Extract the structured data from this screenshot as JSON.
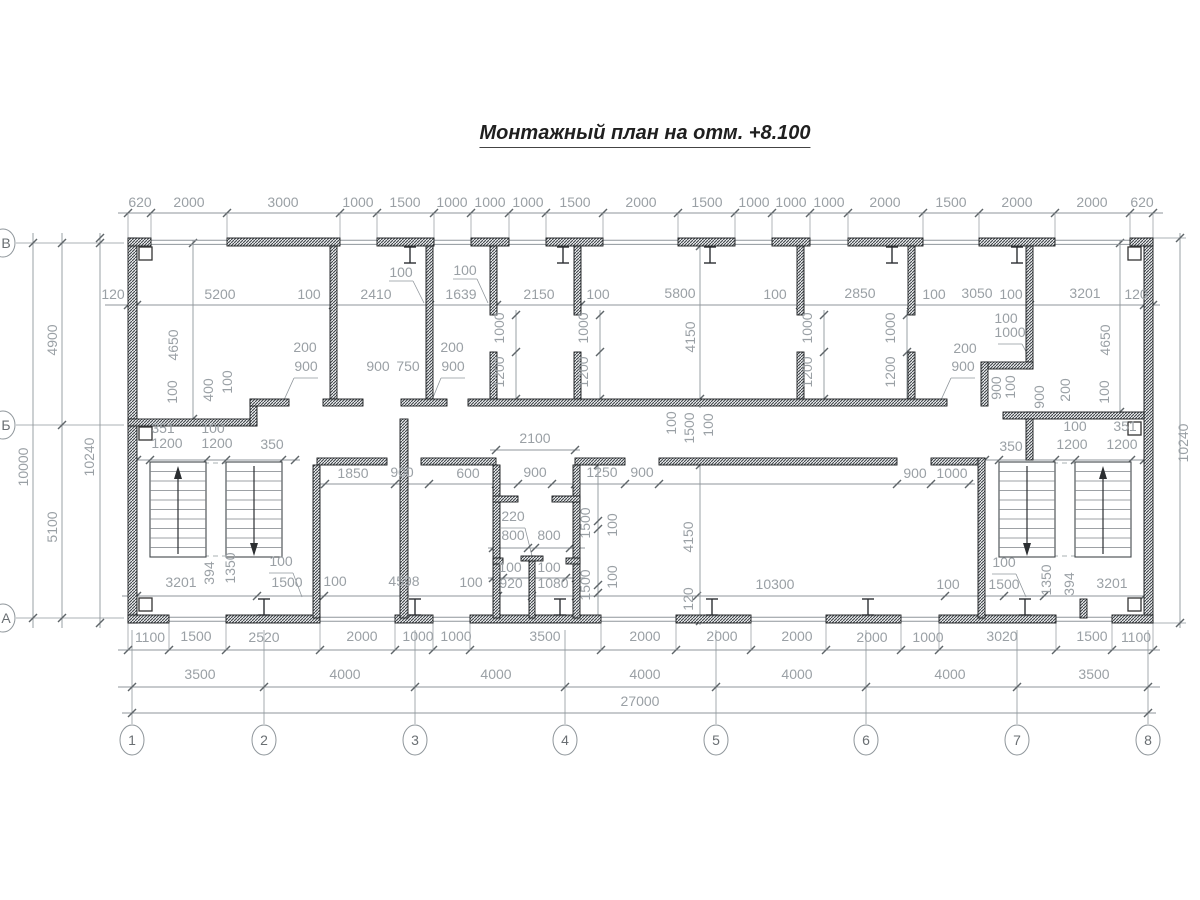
{
  "title": "Монтажный план на отм. +8.100",
  "colors": {
    "dim_text": "#9aa0a5",
    "dim_line": "#8f969b",
    "tick": "#5f6569",
    "wall_edge": "#16191b",
    "stair": "#42474b",
    "bubble": "#8f969b"
  },
  "labels": [
    [
      140,
      207,
      "620"
    ],
    [
      189,
      207,
      "2000"
    ],
    [
      283,
      207,
      "3000"
    ],
    [
      358,
      207,
      "1000"
    ],
    [
      405,
      207,
      "1500"
    ],
    [
      452,
      207,
      "1000"
    ],
    [
      490,
      207,
      "1000"
    ],
    [
      528,
      207,
      "1000"
    ],
    [
      575,
      207,
      "1500"
    ],
    [
      641,
      207,
      "2000"
    ],
    [
      707,
      207,
      "1500"
    ],
    [
      754,
      207,
      "1000"
    ],
    [
      791,
      207,
      "1000"
    ],
    [
      829,
      207,
      "1000"
    ],
    [
      885,
      207,
      "2000"
    ],
    [
      951,
      207,
      "1500"
    ],
    [
      1017,
      207,
      "2000"
    ],
    [
      1092,
      207,
      "2000"
    ],
    [
      1142,
      207,
      "620"
    ],
    [
      113,
      299,
      "120"
    ],
    [
      220,
      299,
      "5200"
    ],
    [
      309,
      299,
      "100"
    ],
    [
      376,
      299,
      "2410"
    ],
    [
      461,
      299,
      "1639"
    ],
    [
      539,
      299,
      "2150"
    ],
    [
      598,
      299,
      "100"
    ],
    [
      680,
      298,
      "5800"
    ],
    [
      775,
      299,
      "100"
    ],
    [
      860,
      298,
      "2850"
    ],
    [
      934,
      299,
      "100"
    ],
    [
      977,
      298,
      "3050"
    ],
    [
      1011,
      299,
      "100"
    ],
    [
      1085,
      298,
      "3201"
    ],
    [
      1136,
      299,
      "120"
    ],
    [
      401,
      277,
      "100"
    ],
    [
      465,
      275,
      "100"
    ],
    [
      28,
      467,
      "10000",
      -90
    ],
    [
      57,
      340,
      "4900",
      -90
    ],
    [
      57,
      527,
      "5100",
      -90
    ],
    [
      94,
      457,
      "10240",
      -90
    ],
    [
      1188,
      443,
      "10240",
      -90
    ],
    [
      178,
      345,
      "4650",
      -90
    ],
    [
      177,
      392,
      "100",
      -90
    ],
    [
      213,
      390,
      "400",
      -90
    ],
    [
      232,
      382,
      "100",
      -90
    ],
    [
      1110,
      340,
      "4650",
      -90
    ],
    [
      1109,
      392,
      "100",
      -90
    ],
    [
      1070,
      390,
      "200",
      -90
    ],
    [
      504,
      328,
      "1000",
      -90
    ],
    [
      504,
      372,
      "1200",
      -90
    ],
    [
      588,
      328,
      "1000",
      -90
    ],
    [
      588,
      372,
      "1200",
      -90
    ],
    [
      812,
      328,
      "1000",
      -90
    ],
    [
      812,
      372,
      "1200",
      -90
    ],
    [
      895,
      328,
      "1000",
      -90
    ],
    [
      895,
      372,
      "1200",
      -90
    ],
    [
      695,
      337,
      "4150",
      -90
    ],
    [
      305,
      352,
      "200"
    ],
    [
      306,
      371,
      "900"
    ],
    [
      378,
      371,
      "900"
    ],
    [
      408,
      371,
      "750"
    ],
    [
      452,
      352,
      "200"
    ],
    [
      453,
      371,
      "900"
    ],
    [
      965,
      353,
      "200"
    ],
    [
      963,
      371,
      "900"
    ],
    [
      1006,
      323,
      "100"
    ],
    [
      1010,
      337,
      "1000"
    ],
    [
      1001,
      388,
      "900",
      -90
    ],
    [
      1015,
      387,
      "100",
      -90
    ],
    [
      1044,
      397,
      "900",
      -90
    ],
    [
      163,
      433,
      "351"
    ],
    [
      213,
      433,
      "100"
    ],
    [
      167,
      448,
      "1200"
    ],
    [
      217,
      448,
      "1200"
    ],
    [
      272,
      449,
      "350"
    ],
    [
      1125,
      431,
      "351"
    ],
    [
      1075,
      431,
      "100"
    ],
    [
      1072,
      449,
      "1200"
    ],
    [
      1122,
      449,
      "1200"
    ],
    [
      1011,
      451,
      "350"
    ],
    [
      676,
      423,
      "100",
      -90
    ],
    [
      694,
      428,
      "1500",
      -90
    ],
    [
      713,
      425,
      "100",
      -90
    ],
    [
      353,
      478,
      "1850"
    ],
    [
      402,
      477,
      "900"
    ],
    [
      468,
      478,
      "600"
    ],
    [
      535,
      443,
      "2100"
    ],
    [
      535,
      477,
      "900"
    ],
    [
      602,
      477,
      "1250"
    ],
    [
      642,
      477,
      "900"
    ],
    [
      915,
      478,
      "900"
    ],
    [
      952,
      478,
      "1000"
    ],
    [
      513,
      521,
      "220"
    ],
    [
      513,
      540,
      "800"
    ],
    [
      549,
      540,
      "800"
    ],
    [
      510,
      572,
      "100"
    ],
    [
      549,
      572,
      "100"
    ],
    [
      590,
      523,
      "1500",
      -90
    ],
    [
      617,
      525,
      "100",
      -90
    ],
    [
      590,
      585,
      "1500",
      -90
    ],
    [
      617,
      577,
      "100",
      -90
    ],
    [
      693,
      537,
      "4150",
      -90
    ],
    [
      693,
      599,
      "120",
      -90
    ],
    [
      181,
      587,
      "3201"
    ],
    [
      287,
      587,
      "1500"
    ],
    [
      335,
      586,
      "100"
    ],
    [
      404,
      586,
      "4598"
    ],
    [
      471,
      587,
      "100"
    ],
    [
      511,
      588,
      "920"
    ],
    [
      553,
      588,
      "1080"
    ],
    [
      775,
      589,
      "10300"
    ],
    [
      948,
      589,
      "100"
    ],
    [
      1004,
      589,
      "1500"
    ],
    [
      1112,
      588,
      "3201"
    ],
    [
      214,
      573,
      "394",
      -90
    ],
    [
      235,
      568,
      "1350",
      -90
    ],
    [
      1051,
      580,
      "1350",
      -90
    ],
    [
      1074,
      584,
      "394",
      -90
    ],
    [
      281,
      566,
      "100"
    ],
    [
      1004,
      567,
      "100"
    ],
    [
      150,
      642,
      "1100"
    ],
    [
      196,
      641,
      "1500"
    ],
    [
      264,
      642,
      "2520"
    ],
    [
      362,
      641,
      "2000"
    ],
    [
      418,
      641,
      "1000"
    ],
    [
      456,
      641,
      "1000"
    ],
    [
      545,
      641,
      "3500"
    ],
    [
      645,
      641,
      "2000"
    ],
    [
      722,
      641,
      "2000"
    ],
    [
      797,
      641,
      "2000"
    ],
    [
      872,
      642,
      "2000"
    ],
    [
      928,
      642,
      "1000"
    ],
    [
      1002,
      641,
      "3020"
    ],
    [
      1092,
      641,
      "1500"
    ],
    [
      1136,
      642,
      "1100"
    ],
    [
      200,
      679,
      "3500"
    ],
    [
      345,
      679,
      "4000"
    ],
    [
      496,
      679,
      "4000"
    ],
    [
      645,
      679,
      "4000"
    ],
    [
      797,
      679,
      "4000"
    ],
    [
      950,
      679,
      "4000"
    ],
    [
      1094,
      679,
      "3500"
    ],
    [
      640,
      706,
      "27000"
    ]
  ],
  "walls": [
    [
      128,
      238,
      9,
      385
    ],
    [
      1144,
      238,
      9,
      385
    ],
    [
      128,
      238,
      23,
      8
    ],
    [
      227,
      238,
      113,
      8
    ],
    [
      377,
      238,
      57,
      8
    ],
    [
      471,
      238,
      38,
      8
    ],
    [
      546,
      238,
      57,
      8
    ],
    [
      678,
      238,
      57,
      8
    ],
    [
      772,
      238,
      38,
      8
    ],
    [
      848,
      238,
      75,
      8
    ],
    [
      979,
      238,
      76,
      8
    ],
    [
      1130,
      238,
      23,
      8
    ],
    [
      128,
      615,
      41,
      8
    ],
    [
      226,
      615,
      94,
      8
    ],
    [
      395,
      615,
      38,
      8
    ],
    [
      470,
      615,
      131,
      8
    ],
    [
      676,
      615,
      75,
      8
    ],
    [
      826,
      615,
      75,
      8
    ],
    [
      939,
      615,
      117,
      8
    ],
    [
      1112,
      615,
      41,
      8
    ],
    [
      330,
      246,
      7,
      153
    ],
    [
      426,
      246,
      7,
      153
    ],
    [
      490,
      246,
      7,
      69
    ],
    [
      490,
      352,
      7,
      47
    ],
    [
      574,
      246,
      7,
      69
    ],
    [
      574,
      352,
      7,
      47
    ],
    [
      797,
      246,
      7,
      69
    ],
    [
      797,
      352,
      7,
      47
    ],
    [
      908,
      246,
      7,
      69
    ],
    [
      908,
      352,
      7,
      47
    ],
    [
      1026,
      246,
      7,
      123
    ],
    [
      981,
      362,
      52,
      7
    ],
    [
      981,
      362,
      7,
      44
    ],
    [
      1026,
      412,
      7,
      48
    ],
    [
      468,
      399,
      479,
      7
    ],
    [
      128,
      419,
      129,
      7
    ],
    [
      250,
      399,
      7,
      27
    ],
    [
      250,
      399,
      39,
      7
    ],
    [
      323,
      399,
      40,
      7
    ],
    [
      401,
      399,
      46,
      7
    ],
    [
      1003,
      412,
      141,
      7
    ],
    [
      317,
      458,
      70,
      7
    ],
    [
      421,
      458,
      75,
      7
    ],
    [
      575,
      458,
      50,
      7
    ],
    [
      659,
      458,
      238,
      7
    ],
    [
      931,
      458,
      54,
      7
    ],
    [
      313,
      465,
      7,
      153
    ],
    [
      400,
      419,
      8,
      199
    ],
    [
      493,
      465,
      7,
      153
    ],
    [
      573,
      465,
      7,
      153
    ],
    [
      529,
      556,
      6,
      62
    ],
    [
      521,
      556,
      22,
      5
    ],
    [
      493,
      496,
      25,
      6
    ],
    [
      552,
      496,
      28,
      6
    ],
    [
      493,
      558,
      10,
      6
    ],
    [
      566,
      558,
      14,
      6
    ],
    [
      978,
      458,
      7,
      160
    ],
    [
      1080,
      599,
      7,
      19
    ]
  ],
  "windows": [
    {
      "ys": [
        240.3,
        244.4
      ],
      "gaps": [
        [
          151,
          227
        ],
        [
          340,
          377
        ],
        [
          434,
          471
        ],
        [
          509,
          546
        ],
        [
          603,
          678
        ],
        [
          735,
          772
        ],
        [
          810,
          848
        ],
        [
          923,
          979
        ],
        [
          1055,
          1130
        ]
      ]
    },
    {
      "ys": [
        617.2,
        621.3
      ],
      "gaps": [
        [
          169,
          226
        ],
        [
          320,
          395
        ],
        [
          433,
          470
        ],
        [
          601,
          676
        ],
        [
          751,
          826
        ],
        [
          901,
          939
        ],
        [
          1056,
          1112
        ]
      ]
    }
  ],
  "dimlines_h": [
    {
      "y": 213,
      "x1": 118,
      "x2": 1163,
      "t": [
        128,
        151,
        227,
        340,
        377,
        434,
        471,
        509,
        546,
        603,
        678,
        735,
        772,
        810,
        848,
        923,
        979,
        1055,
        1130,
        1153
      ],
      "e": 238
    },
    {
      "y": 305,
      "x1": 105,
      "x2": 1160,
      "t": [
        128,
        137,
        333,
        430,
        497,
        581,
        800,
        911,
        1030,
        1144,
        1153
      ]
    },
    {
      "y": 596,
      "x1": 122,
      "x2": 1150,
      "t": [
        137,
        257,
        324,
        498,
        532,
        576,
        697,
        945,
        1004,
        1044,
        1144
      ]
    },
    {
      "y": 650,
      "x1": 118,
      "x2": 1160,
      "t": [
        128,
        169,
        226,
        320,
        395,
        433,
        470,
        601,
        676,
        751,
        826,
        901,
        939,
        1056,
        1112,
        1153
      ],
      "e": 623
    },
    {
      "y": 687,
      "x1": 118,
      "x2": 1160,
      "t": [
        132,
        264,
        415,
        565,
        716,
        866,
        1017,
        1148
      ]
    },
    {
      "y": 713,
      "x1": 122,
      "x2": 1156,
      "t": [
        132,
        1148
      ]
    },
    {
      "y": 460,
      "x1": 130,
      "x2": 300,
      "t": [
        137,
        150,
        206,
        226,
        282,
        295
      ]
    },
    {
      "y": 460,
      "x1": 985,
      "x2": 1150,
      "t": [
        985,
        999,
        1055,
        1075,
        1131,
        1144
      ]
    },
    {
      "y": 484,
      "x1": 320,
      "x2": 975,
      "t": [
        325,
        395,
        429,
        496,
        518,
        552,
        575,
        625,
        659,
        897,
        931,
        969
      ]
    },
    {
      "y": 450,
      "x1": 490,
      "x2": 580,
      "t": [
        496,
        575
      ]
    },
    {
      "y": 548,
      "x1": 488,
      "x2": 585,
      "t": [
        493,
        528,
        535,
        570
      ]
    },
    {
      "y": 578,
      "x1": 488,
      "x2": 585,
      "t": [
        493,
        503,
        566,
        576
      ]
    }
  ],
  "dimlines_v": [
    {
      "x": 33,
      "y1": 233,
      "y2": 628,
      "t": [
        243,
        618
      ]
    },
    {
      "x": 62,
      "y1": 233,
      "y2": 628,
      "t": [
        243,
        425,
        618
      ]
    },
    {
      "x": 100,
      "y1": 233,
      "y2": 628,
      "t": [
        238,
        243,
        623
      ]
    },
    {
      "x": 1180,
      "y1": 233,
      "y2": 628,
      "t": [
        238,
        623
      ]
    },
    {
      "x": 193,
      "y1": 240,
      "y2": 425,
      "t": [
        243,
        419
      ]
    },
    {
      "x": 1120,
      "y1": 240,
      "y2": 418,
      "t": [
        243,
        412
      ]
    },
    {
      "x": 700,
      "y1": 240,
      "y2": 408,
      "t": [
        246,
        399
      ]
    },
    {
      "x": 700,
      "y1": 460,
      "y2": 625,
      "t": [
        465,
        621
      ]
    },
    {
      "x": 516,
      "y1": 310,
      "y2": 404,
      "t": [
        315,
        352,
        399
      ]
    },
    {
      "x": 600,
      "y1": 310,
      "y2": 404,
      "t": [
        315,
        352,
        399
      ]
    },
    {
      "x": 824,
      "y1": 310,
      "y2": 404,
      "t": [
        315,
        352,
        399
      ]
    },
    {
      "x": 907,
      "y1": 310,
      "y2": 404,
      "t": [
        315,
        352,
        399
      ]
    },
    {
      "x": 598,
      "y1": 460,
      "y2": 620,
      "t": [
        465,
        521,
        529,
        585,
        593
      ]
    }
  ],
  "lines": [
    [
      16,
      243,
      124,
      243
    ],
    [
      16,
      425,
      124,
      425
    ],
    [
      16,
      618,
      124,
      618
    ],
    [
      132,
      724,
      132,
      630
    ],
    [
      264,
      724,
      264,
      630
    ],
    [
      415,
      724,
      415,
      630
    ],
    [
      565,
      724,
      565,
      630
    ],
    [
      716,
      724,
      716,
      630
    ],
    [
      866,
      724,
      866,
      630
    ],
    [
      1017,
      724,
      1017,
      630
    ],
    [
      1148,
      724,
      1148,
      630
    ],
    [
      1150,
      238,
      1186,
      238
    ],
    [
      1150,
      623,
      1186,
      623
    ],
    [
      389,
      281,
      413,
      281
    ],
    [
      413,
      281,
      424,
      303
    ],
    [
      453,
      279,
      477,
      279
    ],
    [
      477,
      279,
      488,
      303
    ],
    [
      294,
      378,
      318,
      378
    ],
    [
      294,
      378,
      284,
      400
    ],
    [
      441,
      378,
      465,
      378
    ],
    [
      441,
      378,
      432,
      400
    ],
    [
      951,
      378,
      975,
      378
    ],
    [
      951,
      378,
      941,
      400
    ],
    [
      998,
      344,
      1022,
      344
    ],
    [
      1022,
      344,
      1032,
      363
    ],
    [
      269,
      573,
      293,
      573
    ],
    [
      293,
      573,
      302,
      597
    ],
    [
      992,
      574,
      1016,
      574
    ],
    [
      1016,
      574,
      1026,
      597
    ],
    [
      501,
      528,
      525,
      528
    ],
    [
      525,
      528,
      532,
      556
    ],
    [
      150,
      463,
      282,
      463,
      1
    ],
    [
      999,
      463,
      1131,
      463,
      1
    ],
    [
      150,
      556,
      282,
      556,
      1
    ],
    [
      999,
      556,
      1131,
      556,
      1
    ]
  ],
  "squares": {
    "size": 13,
    "pos": [
      [
        139,
        247
      ],
      [
        139,
        427
      ],
      [
        139,
        598
      ],
      [
        1128,
        247
      ],
      [
        1128,
        422
      ],
      [
        1128,
        598
      ]
    ]
  },
  "columns": [
    {
      "y1": 247,
      "y2": 263,
      "xs": [
        410,
        563,
        710,
        892,
        1017
      ]
    },
    {
      "y1": 599,
      "y2": 615,
      "xs": [
        264,
        415,
        560,
        712,
        868,
        1025
      ]
    }
  ],
  "stairs": {
    "tread_step": 9.5,
    "blocks": [
      {
        "flights": [
          [
            150,
            462,
            56,
            95
          ],
          [
            226,
            462,
            56,
            95
          ]
        ],
        "arrows": [
          {
            "x": 178,
            "dir": "up"
          },
          {
            "x": 254,
            "dir": "down"
          }
        ]
      },
      {
        "flights": [
          [
            999,
            462,
            56,
            95
          ],
          [
            1075,
            462,
            56,
            95
          ]
        ],
        "arrows": [
          {
            "x": 1027,
            "dir": "down"
          },
          {
            "x": 1103,
            "dir": "up"
          }
        ]
      }
    ]
  },
  "bubbles": {
    "bottom": {
      "cy": 740,
      "rx": 12,
      "ry": 15,
      "items": [
        {
          "label": "1",
          "x": 132
        },
        {
          "label": "2",
          "x": 264
        },
        {
          "label": "3",
          "x": 415
        },
        {
          "label": "4",
          "x": 565
        },
        {
          "label": "5",
          "x": 716
        },
        {
          "label": "6",
          "x": 866
        },
        {
          "label": "7",
          "x": 1017
        },
        {
          "label": "8",
          "x": 1148
        }
      ]
    },
    "left": {
      "cx": 3,
      "rx": 12,
      "ry": 14,
      "items": [
        {
          "label": "В",
          "y": 243
        },
        {
          "label": "Б",
          "y": 425
        },
        {
          "label": "А",
          "y": 618
        }
      ]
    }
  }
}
